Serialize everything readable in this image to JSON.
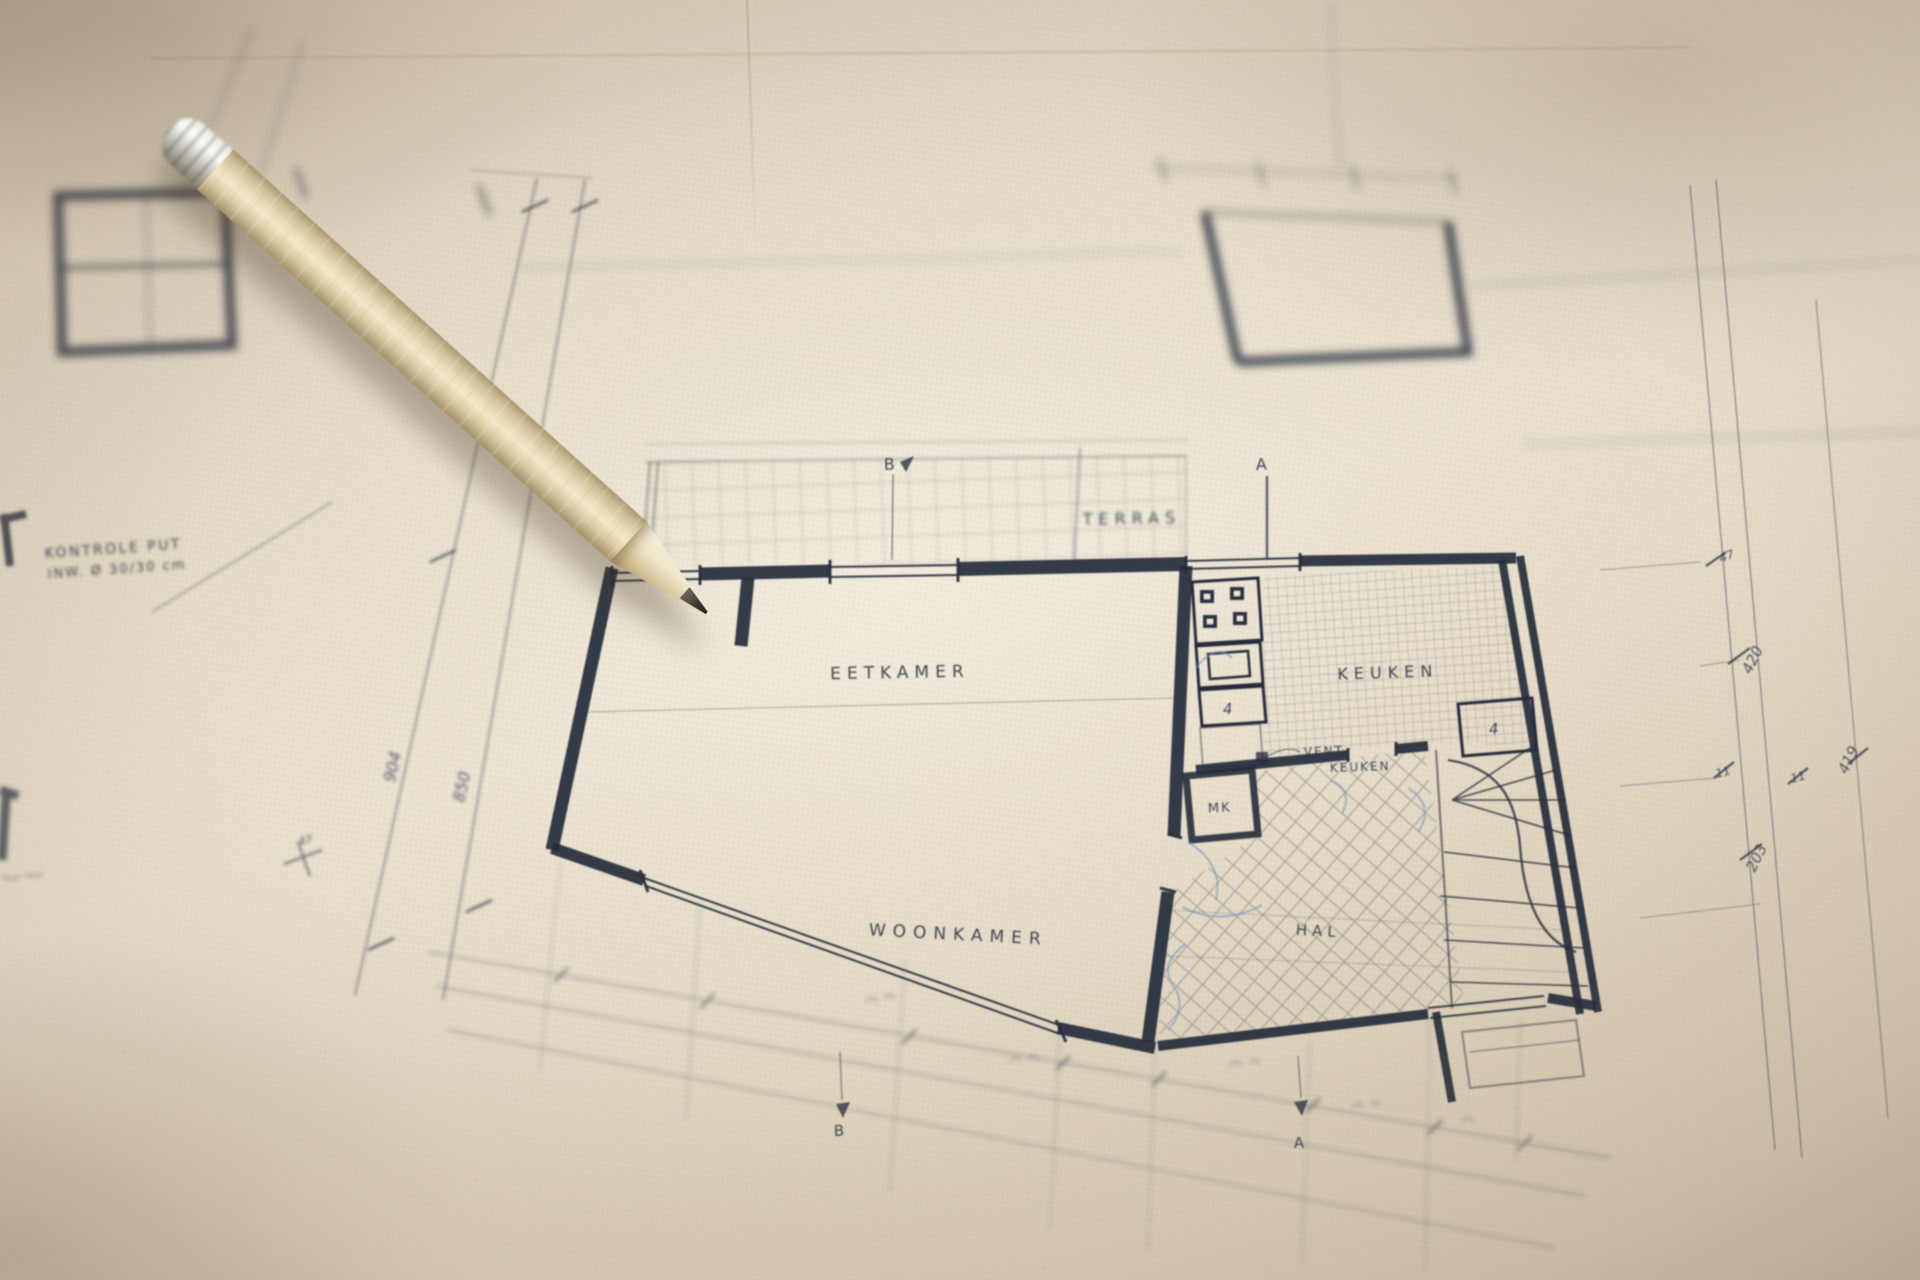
{
  "floor_plan": {
    "rooms": {
      "terras": "TERRAS",
      "eetkamer": "EETKAMER",
      "keuken": "KEUKEN",
      "woonkamer": "WOONKAMER",
      "hal": "HAL"
    },
    "labels": {
      "vent_line1": "VENT.",
      "vent_line2": "KEUKEN",
      "meterkast": "MK",
      "counter_marker": "4",
      "stair_marker": "4"
    },
    "note": {
      "line1": "KONTROLE PUT",
      "line2": "INW. Ø 30/30 cm"
    },
    "section_markers": {
      "top_b": "B",
      "top_a": "A",
      "bottom_b": "B",
      "bottom_a": "A"
    },
    "dimensions": {
      "left_904": "904",
      "left_850": "850",
      "left_47": "47",
      "right_47": "47",
      "right_420": "420",
      "right_11a": "11",
      "right_11b": "11",
      "right_203": "203",
      "right_419": "419"
    }
  },
  "colors": {
    "ink": "#252c3c",
    "paper": "#e6dcc9",
    "paper_shadow": "#c9bca6",
    "blue_pencil": "#6f93c4",
    "pencil_wood": "#e9dcba",
    "pencil_lead": "#3d3b34",
    "ferrule_metal": "#b4b1a7"
  }
}
